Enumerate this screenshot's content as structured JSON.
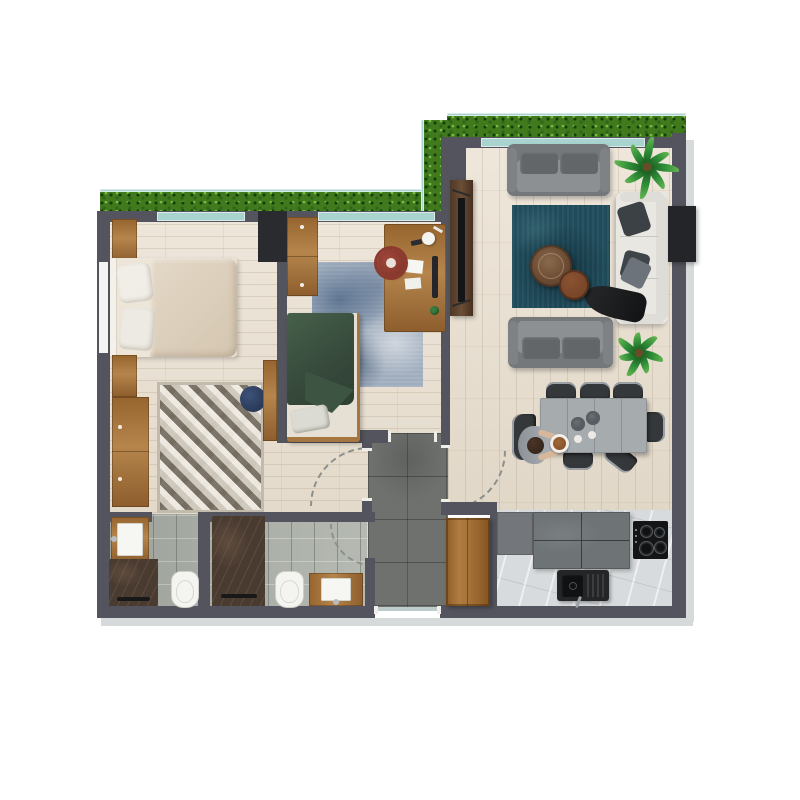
{
  "plan": {
    "kind": "apartment-floor-plan-render",
    "visible_text": "none",
    "palette": {
      "wall": "#53545d",
      "wood_floor": "#e9dfcf",
      "marble_floor": "#d8dbdd",
      "concrete_hall": "#6f716f",
      "bath_tile": "#a9aea6",
      "hedge_green": "#417a1d",
      "glass_teal": "#a8d3cf",
      "rug_teal": "#1f4b5a",
      "rug_blue": "#9fadbd",
      "rug_geometric": "#d8d2c6",
      "furniture_wood": "#b5854c",
      "walnut": "#5a4130",
      "sofa_gray": "#75787b",
      "sofa_white": "#e9e7e2",
      "bed_green": "#3e5642",
      "bed_beige": "#ddd0bc",
      "desk_chair_red": "#8d3a2e",
      "pouf_navy": "#2c3e5e",
      "shower_stone": "#4a3b31",
      "appliance_black": "#17181a"
    },
    "rooms": [
      {
        "name": "bedroom-1",
        "items": [
          "double-bed",
          "nightstand-top",
          "nightstand-bottom",
          "wardrobe",
          "geometric-rug",
          "navy-pouf",
          "closet-strip",
          "window-left",
          "window-top"
        ]
      },
      {
        "name": "bedroom-2-study",
        "items": [
          "green-single-bed",
          "wardrobe",
          "blue-rug",
          "desk",
          "red-desk-chair",
          "desk-lamp",
          "monitor",
          "papers",
          "window-top"
        ]
      },
      {
        "name": "living-dining",
        "items": [
          "gray-sofa-top",
          "gray-sofa-bottom",
          "white-sofa",
          "tv-console",
          "tv",
          "teal-rug",
          "round-coffee-table-large",
          "round-coffee-table-small",
          "palm-plant-1",
          "palm-plant-2",
          "dining-table",
          "dining-chairs",
          "seated-person",
          "plates-and-bowls",
          "black-wall-unit"
        ]
      },
      {
        "name": "kitchen",
        "items": [
          "gray-cabinet",
          "stone-counter",
          "induction-cooktop",
          "black-sink",
          "open-wood-door"
        ]
      },
      {
        "name": "bathroom-ensuite",
        "items": [
          "washbasin",
          "stone-shower",
          "toilet"
        ]
      },
      {
        "name": "bathroom-guest",
        "items": [
          "stone-shower",
          "toilet",
          "washbasin",
          "door-swing-arc"
        ]
      },
      {
        "name": "entry-hall",
        "items": [
          "concrete-floor",
          "entry-door",
          "door-swing-arc-living",
          "door-swing-arc-hallway"
        ]
      },
      {
        "name": "balcony-planter",
        "items": [
          "hedge-left-wing",
          "hedge-right-wing",
          "hedge-corner",
          "glass-railing"
        ]
      }
    ]
  }
}
